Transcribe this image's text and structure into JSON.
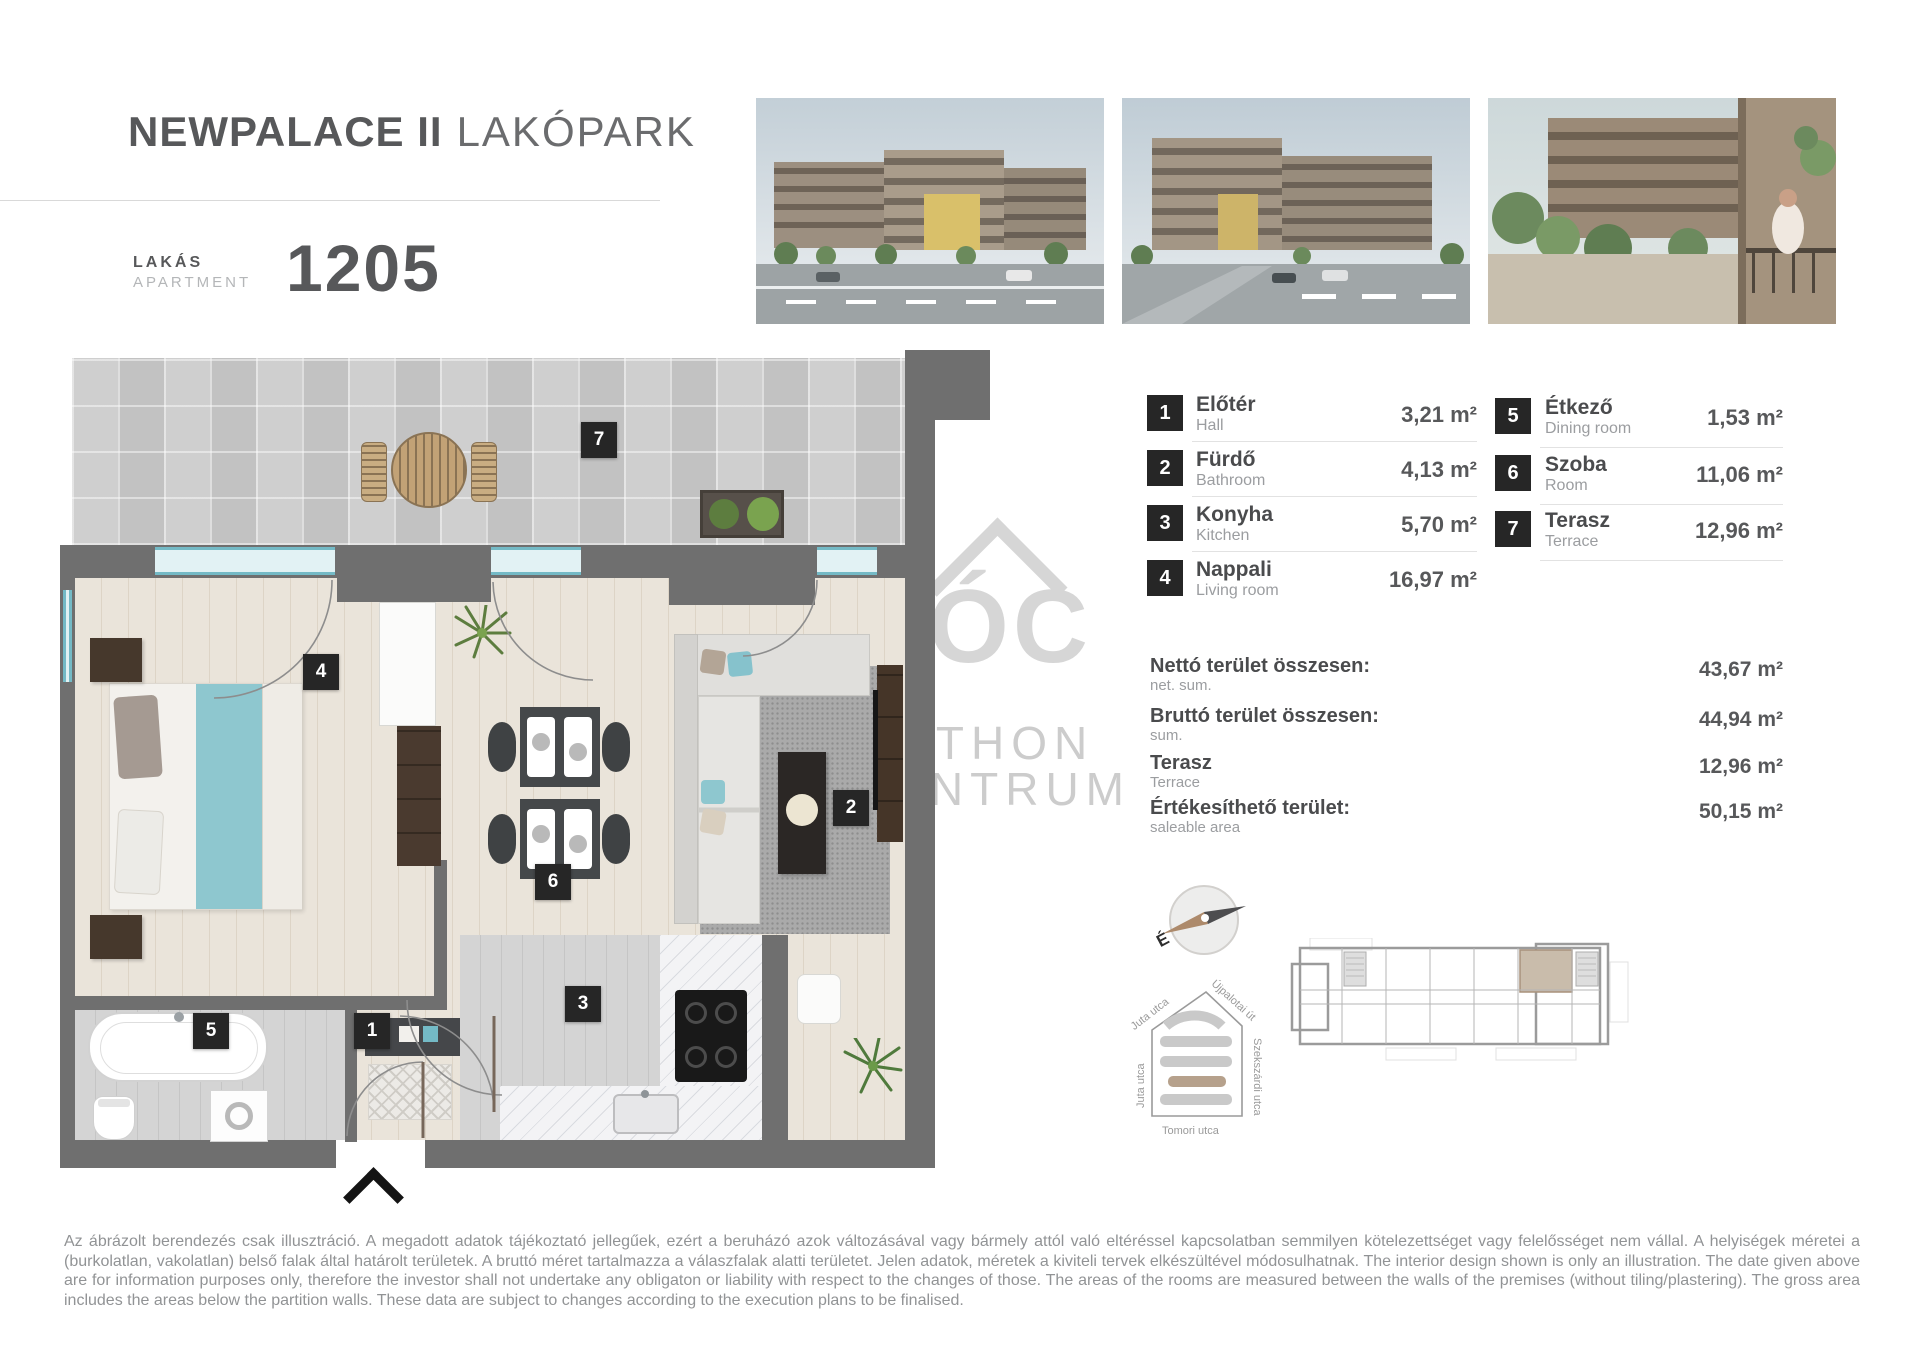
{
  "header": {
    "project_name": "NEWPALACE II",
    "project_type": "LAKÓPARK",
    "unit_label_hu": "LAKÁS",
    "unit_label_en": "APARTMENT",
    "unit_number": "1205"
  },
  "legend": {
    "left": [
      {
        "num": "1",
        "name_hu": "Előtér",
        "name_en": "Hall",
        "area": "3,21 m²"
      },
      {
        "num": "2",
        "name_hu": "Fürdő",
        "name_en": "Bathroom",
        "area": "4,13 m²"
      },
      {
        "num": "3",
        "name_hu": "Konyha",
        "name_en": "Kitchen",
        "area": "5,70 m²"
      },
      {
        "num": "4",
        "name_hu": "Nappali",
        "name_en": "Living room",
        "area": "16,97 m²"
      }
    ],
    "right": [
      {
        "num": "5",
        "name_hu": "Étkező",
        "name_en": "Dining room",
        "area": "1,53 m²"
      },
      {
        "num": "6",
        "name_hu": "Szoba",
        "name_en": "Room",
        "area": "11,06 m²"
      },
      {
        "num": "7",
        "name_hu": "Terasz",
        "name_en": "Terrace",
        "area": "12,96 m²"
      }
    ]
  },
  "summary": [
    {
      "label_hu": "Nettó terület összesen:",
      "label_en": "net. sum.",
      "value": "43,67 m²"
    },
    {
      "label_hu": "Bruttó terület összesen:",
      "label_en": "sum.",
      "value": "44,94 m²"
    },
    {
      "label_hu": "Terasz",
      "label_en": "Terrace",
      "value": "12,96 m²"
    },
    {
      "label_hu": "Értékesíthető terület:",
      "label_en": "saleable area",
      "value": "50,15 m²"
    }
  ],
  "plan": {
    "r1": "1",
    "r2": "2",
    "r3": "3",
    "r4": "4",
    "r5": "5",
    "r6": "6",
    "r7": "7"
  },
  "compass": {
    "north": "É"
  },
  "site_map": {
    "street_top_left": "Juta utca",
    "street_top_right": "Újpalotai út",
    "street_right": "Szekszárdi utca",
    "street_left": "Juta utca",
    "street_bottom": "Tomori utca"
  },
  "watermark": {
    "logo": "ÓC",
    "line1": "OTTHON",
    "line2": "CENTRUM"
  },
  "colors": {
    "accent_teal": "#74bac6",
    "wall_gray": "#6f6f6f",
    "label_black": "#262626",
    "highlight_tan": "#c9bcab"
  },
  "photos": [
    {
      "name": "building-exterior-render-1"
    },
    {
      "name": "building-exterior-render-2"
    },
    {
      "name": "terrace-lifestyle-render"
    }
  ],
  "disclaimer": "Az ábrázolt berendezés csak illusztráció. A megadott adatok tájékoztató jellegűek, ezért a beruházó azok változásával vagy bármely attól való eltéréssel kapcsolatban semmilyen kötelezettséget vagy felelősséget nem vállal. A helyiségek méretei a (burkolatlan, vakolatlan) belső falak által határolt területek. A bruttó méret tartalmazza a válaszfalak alatti területet. Jelen adatok, méretek a kiviteli tervek elkészültével módosulhatnak. The interior design shown is only an illustration. The date given above are for information purposes only, therefore the investor shall not undertake any obligaton or liability with respect to the changes of those. The areas of the rooms are measured between the walls of the premises (without tiling/plastering). The gross area includes the areas below the partition walls. These data are subject to changes according to the execution plans to be finalised."
}
